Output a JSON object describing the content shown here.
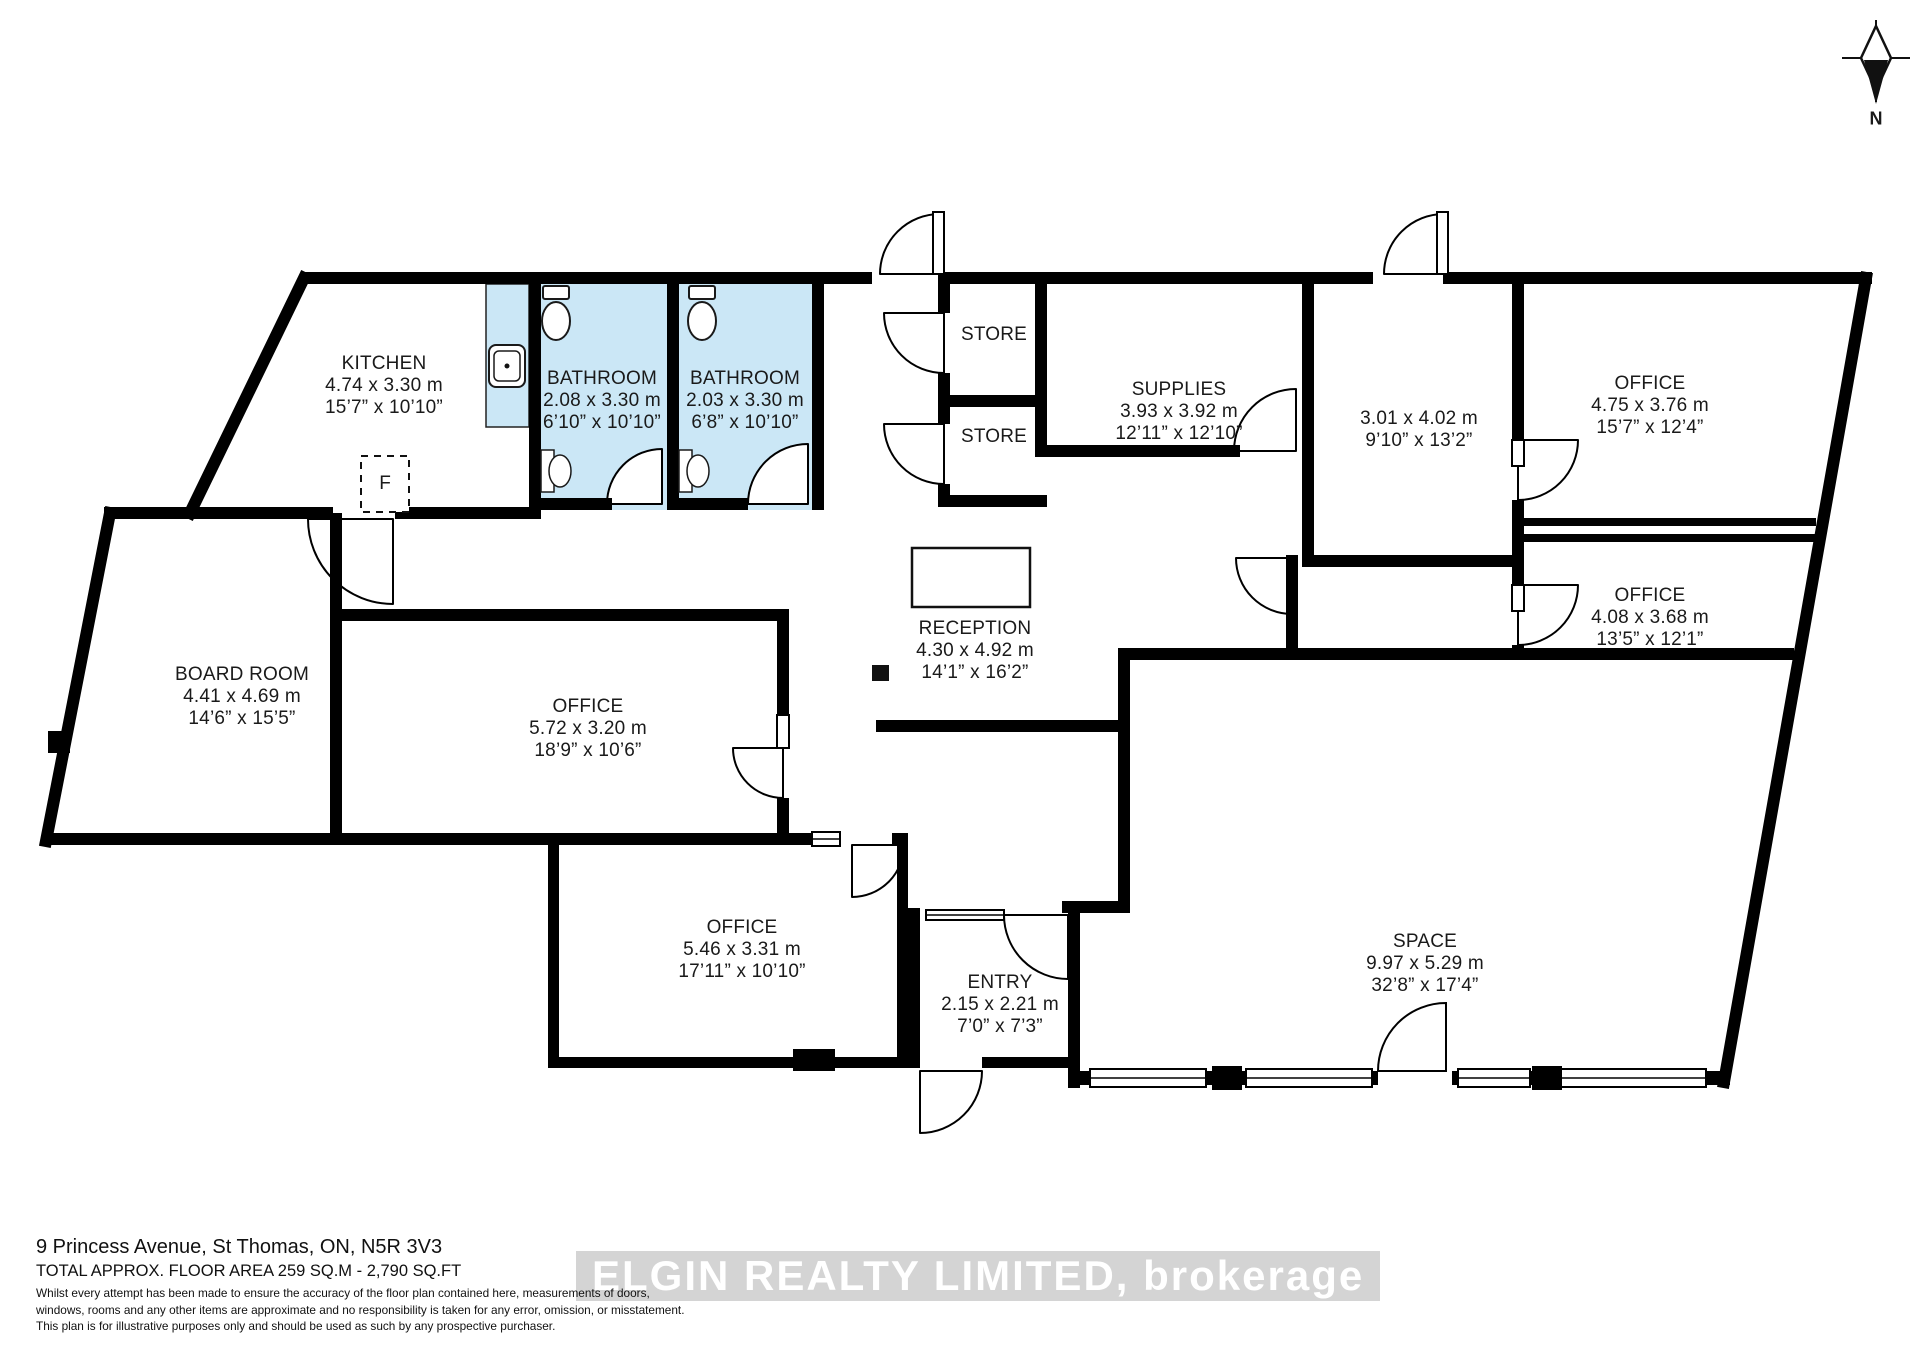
{
  "meta": {
    "address": "9 Princess Avenue, St Thomas, ON, N5R 3V3",
    "total_area": "TOTAL APPROX. FLOOR AREA 259 SQ.M - 2,790 SQ.FT",
    "disclaimer_line1": "Whilst every attempt has been made to ensure the accuracy of the floor plan contained here, measurements of doors,",
    "disclaimer_line2": "windows, rooms and any other items are approximate and no responsibility is taken for any error, omission, or misstatement.",
    "disclaimer_line3": "This plan is for illustrative purposes only and should be used as such by any prospective purchaser.",
    "watermark": "ELGIN REALTY LIMITED, brokerage",
    "fridge_label": "F"
  },
  "compass": {
    "label": "N"
  },
  "colors": {
    "bathroom": "#cbe7f6",
    "wall": "#000000"
  },
  "rooms": [
    {
      "name": "KITCHEN",
      "metric": "4.74 x 3.30 m",
      "imperial": "15’7” x 10’10”"
    },
    {
      "name": "BATHROOM",
      "metric": "2.08 x 3.30 m",
      "imperial": "6’10” x 10’10”"
    },
    {
      "name": "BATHROOM",
      "metric": "2.03 x 3.30 m",
      "imperial": "6’8” x 10’10”"
    },
    {
      "name": "STORE",
      "metric": "",
      "imperial": ""
    },
    {
      "name": "STORE",
      "metric": "",
      "imperial": ""
    },
    {
      "name": "SUPPLIES",
      "metric": "3.93 x 3.92 m",
      "imperial": "12’11” x 12’10”"
    },
    {
      "name": "",
      "metric": "3.01 x 4.02 m",
      "imperial": "9’10” x 13’2”"
    },
    {
      "name": "OFFICE",
      "metric": "4.75 x 3.76 m",
      "imperial": "15’7” x 12’4”"
    },
    {
      "name": "OFFICE",
      "metric": "4.08 x 3.68 m",
      "imperial": "13’5” x 12’1”"
    },
    {
      "name": "BOARD ROOM",
      "metric": "4.41 x 4.69 m",
      "imperial": "14’6” x 15’5”"
    },
    {
      "name": "OFFICE",
      "metric": "5.72 x 3.20 m",
      "imperial": "18’9” x 10’6”"
    },
    {
      "name": "RECEPTION",
      "metric": "4.30 x 4.92 m",
      "imperial": "14’1” x 16’2”"
    },
    {
      "name": "OFFICE",
      "metric": "5.46 x 3.31 m",
      "imperial": "17’11” x 10’10”"
    },
    {
      "name": "ENTRY",
      "metric": "2.15 x 2.21 m",
      "imperial": "7’0” x 7’3”"
    },
    {
      "name": "SPACE",
      "metric": "9.97 x 5.29 m",
      "imperial": "32’8” x 17’4”"
    }
  ]
}
